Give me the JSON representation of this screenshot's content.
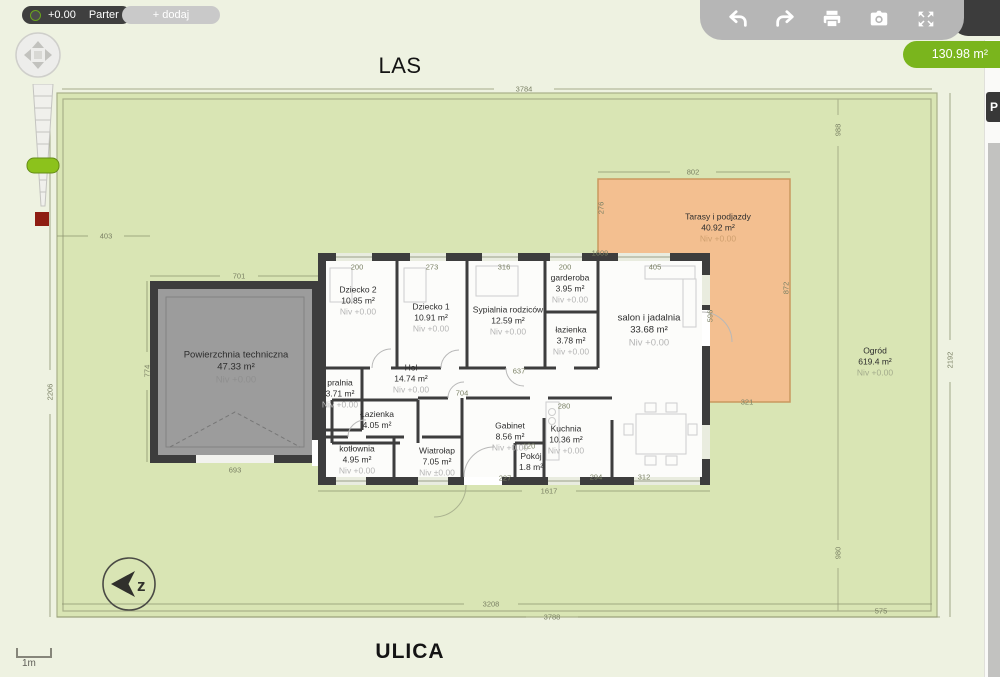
{
  "toolbar": {
    "level_value": "+0.00",
    "level_name": "Parter",
    "add_label": "+ dodaj"
  },
  "topright": {
    "icons": [
      "undo",
      "redo",
      "print",
      "camera",
      "fullscreen"
    ],
    "area_badge": "130.98 m²"
  },
  "side_panel": {
    "tab_label": "P"
  },
  "environment": {
    "top_label": "LAS",
    "bottom_label": "ULICA",
    "scale_label": "1m",
    "compass_letter": "z"
  },
  "colors": {
    "accent_green": "#7ab51d",
    "garden": "#d9e5b4",
    "terrace": "#f3bf90",
    "wall": "#3d3d3d",
    "garage": "#9c9c9c",
    "toolbar_gray": "#b6b6b6",
    "toolbar_dark": "#3f3f3f"
  },
  "rooms": [
    {
      "name": "Powierzchnia techniczna",
      "area": "47.33 m²",
      "niv": "Niv +0.00",
      "x": 236,
      "y": 368,
      "cls": "lg on-gray"
    },
    {
      "name": "Dziecko 2",
      "area": "10.85 m²",
      "niv": "Niv +0.00",
      "x": 358,
      "y": 301,
      "cls": ""
    },
    {
      "name": "Dziecko 1",
      "area": "10.91 m²",
      "niv": "Niv +0.00",
      "x": 431,
      "y": 318,
      "cls": ""
    },
    {
      "name": "Sypialnia rodziców",
      "area": "12.59 m²",
      "niv": "Niv +0.00",
      "x": 508,
      "y": 321,
      "cls": ""
    },
    {
      "name": "garderoba",
      "area": "3.95 m²",
      "niv": "Niv +0.00",
      "x": 570,
      "y": 289,
      "cls": ""
    },
    {
      "name": "łazienka",
      "area": "3.78 m²",
      "niv": "Niv +0.00",
      "x": 571,
      "y": 341,
      "cls": ""
    },
    {
      "name": "salon i jadalnia",
      "area": "33.68 m²",
      "niv": "Niv +0.00",
      "x": 649,
      "y": 331,
      "cls": "lg"
    },
    {
      "name": "Hol",
      "area": "14.74 m²",
      "niv": "Niv +0.00",
      "x": 411,
      "y": 379,
      "cls": ""
    },
    {
      "name": "pralnia",
      "area": "3.71 m²",
      "niv": "Niv +0.00",
      "x": 340,
      "y": 394,
      "cls": ""
    },
    {
      "name": "Łazienka",
      "area": "4.05 m²",
      "niv": "",
      "x": 377,
      "y": 420,
      "cls": ""
    },
    {
      "name": "Gabinet",
      "area": "8.56 m²",
      "niv": "Niv +0.00",
      "x": 510,
      "y": 437,
      "cls": ""
    },
    {
      "name": "Kuchnia",
      "area": "10.36 m²",
      "niv": "Niv +0.00",
      "x": 566,
      "y": 440,
      "cls": ""
    },
    {
      "name": "kotłownia",
      "area": "4.95 m²",
      "niv": "Niv +0.00",
      "x": 357,
      "y": 460,
      "cls": ""
    },
    {
      "name": "Wiatrołap",
      "area": "7.05 m²",
      "niv": "Niv ±0.00",
      "x": 437,
      "y": 462,
      "cls": ""
    },
    {
      "name": "Pokój",
      "area": "1.8 m²",
      "niv": "",
      "x": 531,
      "y": 462,
      "cls": ""
    },
    {
      "name": "Tarasy i podjazdy",
      "area": "40.92 m²",
      "niv": "Niv +0.00",
      "x": 718,
      "y": 228,
      "cls": "on-orange"
    },
    {
      "name": "Ogród",
      "area": "619.4 m²",
      "niv": "Niv +0.00",
      "x": 875,
      "y": 362,
      "cls": "on-green"
    }
  ],
  "dimensions": [
    {
      "t": "3784",
      "x": 524,
      "y": 89,
      "rot": 0
    },
    {
      "t": "3208",
      "x": 491,
      "y": 604,
      "rot": 0
    },
    {
      "t": "3788",
      "x": 552,
      "y": 617,
      "rot": 0
    },
    {
      "t": "575",
      "x": 881,
      "y": 611,
      "rot": 0
    },
    {
      "t": "403",
      "x": 106,
      "y": 236,
      "rot": 0
    },
    {
      "t": "2206",
      "x": 50,
      "y": 392,
      "rot": 1
    },
    {
      "t": "2192",
      "x": 950,
      "y": 360,
      "rot": 1
    },
    {
      "t": "988",
      "x": 838,
      "y": 130,
      "rot": 1
    },
    {
      "t": "980",
      "x": 838,
      "y": 553,
      "rot": 1
    },
    {
      "t": "802",
      "x": 693,
      "y": 172,
      "rot": 0
    },
    {
      "t": "276",
      "x": 601,
      "y": 208,
      "rot": 1
    },
    {
      "t": "872",
      "x": 786,
      "y": 288,
      "rot": 1
    },
    {
      "t": "596",
      "x": 710,
      "y": 316,
      "rot": 1
    },
    {
      "t": "321",
      "x": 747,
      "y": 402,
      "rot": 0
    },
    {
      "t": "701",
      "x": 239,
      "y": 276,
      "rot": 0
    },
    {
      "t": "774",
      "x": 147,
      "y": 371,
      "rot": 1
    },
    {
      "t": "693",
      "x": 235,
      "y": 470,
      "rot": 0
    },
    {
      "t": "1609",
      "x": 600,
      "y": 253,
      "rot": 0
    },
    {
      "t": "200",
      "x": 357,
      "y": 267,
      "rot": 0
    },
    {
      "t": "273",
      "x": 432,
      "y": 267,
      "rot": 0
    },
    {
      "t": "316",
      "x": 504,
      "y": 267,
      "rot": 0
    },
    {
      "t": "200",
      "x": 565,
      "y": 267,
      "rot": 0
    },
    {
      "t": "405",
      "x": 655,
      "y": 267,
      "rot": 0
    },
    {
      "t": "637",
      "x": 519,
      "y": 371,
      "rot": 0
    },
    {
      "t": "704",
      "x": 462,
      "y": 393,
      "rot": 0
    },
    {
      "t": "1617",
      "x": 549,
      "y": 491,
      "rot": 0
    },
    {
      "t": "227",
      "x": 505,
      "y": 478,
      "rot": 0
    },
    {
      "t": "294",
      "x": 596,
      "y": 477,
      "rot": 0
    },
    {
      "t": "312",
      "x": 644,
      "y": 477,
      "rot": 0
    },
    {
      "t": "280",
      "x": 564,
      "y": 406,
      "rot": 0
    },
    {
      "t": "120",
      "x": 529,
      "y": 446,
      "rot": 0
    }
  ]
}
